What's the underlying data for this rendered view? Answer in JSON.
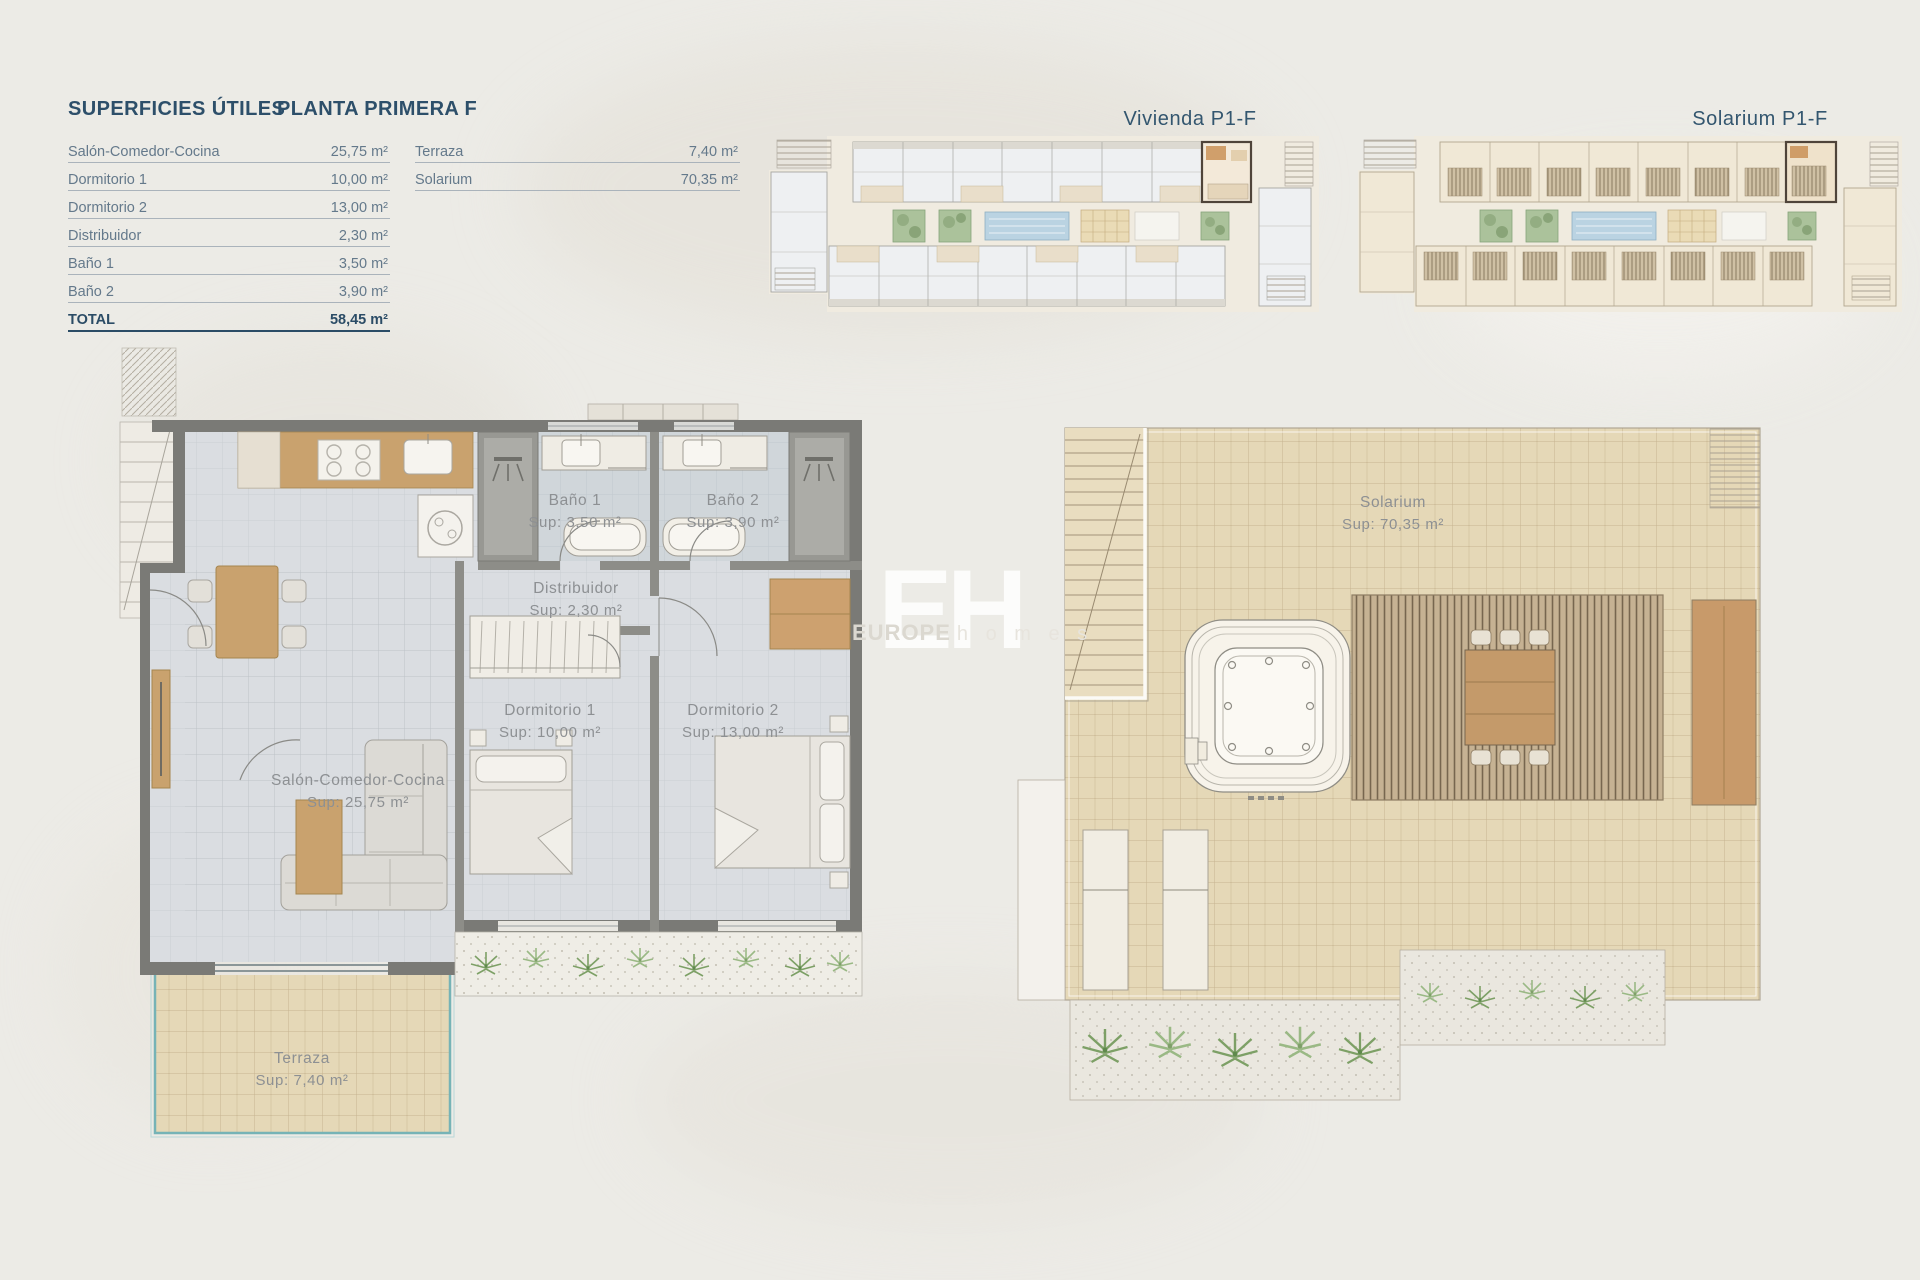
{
  "header": {
    "title_left": "SUPERFICIES ÚTILES",
    "title_right": "PLANTA PRIMERA F"
  },
  "surfaces_table": {
    "rows": [
      {
        "label": "Salón-Comedor-Cocina",
        "value": "25,75 m²"
      },
      {
        "label": "Dormitorio 1",
        "value": "10,00 m²"
      },
      {
        "label": "Dormitorio 2",
        "value": "13,00 m²"
      },
      {
        "label": "Distribuidor",
        "value": "2,30 m²"
      },
      {
        "label": "Baño 1",
        "value": "3,50 m²"
      },
      {
        "label": "Baño 2",
        "value": "3,90 m²"
      }
    ],
    "total": {
      "label": "TOTAL",
      "value": "58,45 m²"
    }
  },
  "secondary_table": {
    "rows": [
      {
        "label": "Terraza",
        "value": "7,40 m²"
      },
      {
        "label": "Solarium",
        "value": "70,35 m²"
      }
    ]
  },
  "overview": {
    "vivienda_label": "Vivienda P1-F",
    "solarium_label": "Solarium P1-F"
  },
  "vivienda_plan": {
    "banyo1": {
      "name": "Baño 1",
      "sup": "Sup: 3,50 m²"
    },
    "banyo2": {
      "name": "Baño 2",
      "sup": "Sup: 3,90 m²"
    },
    "distribuidor": {
      "name": "Distribuidor",
      "sup": "Sup: 2,30 m²"
    },
    "dormitorio1": {
      "name": "Dormitorio 1",
      "sup": "Sup: 10,00 m²"
    },
    "dormitorio2": {
      "name": "Dormitorio 2",
      "sup": "Sup: 13,00 m²"
    },
    "salon": {
      "name": "Salón-Comedor-Cocina",
      "sup": "Sup: 25,75 m²"
    },
    "terraza": {
      "name": "Terraza",
      "sup": "Sup: 7,40 m²"
    }
  },
  "solarium_plan": {
    "solarium": {
      "name": "Solarium",
      "sup": "Sup: 70,35 m²"
    }
  },
  "watermark": {
    "initials": "EH",
    "brand_bold": "EUROPE",
    "brand_light": "h o m e s"
  },
  "colors": {
    "accent_blue": "#2d4f6a",
    "wall_gray": "#7a7a76",
    "wood": "#c9a26e",
    "tile_beige": "#e5d8b7",
    "tile_gray": "#dadde1",
    "balustrade_teal": "#76b3b6",
    "plant_green": "#7da066",
    "pool_blue": "#bad3e2"
  }
}
